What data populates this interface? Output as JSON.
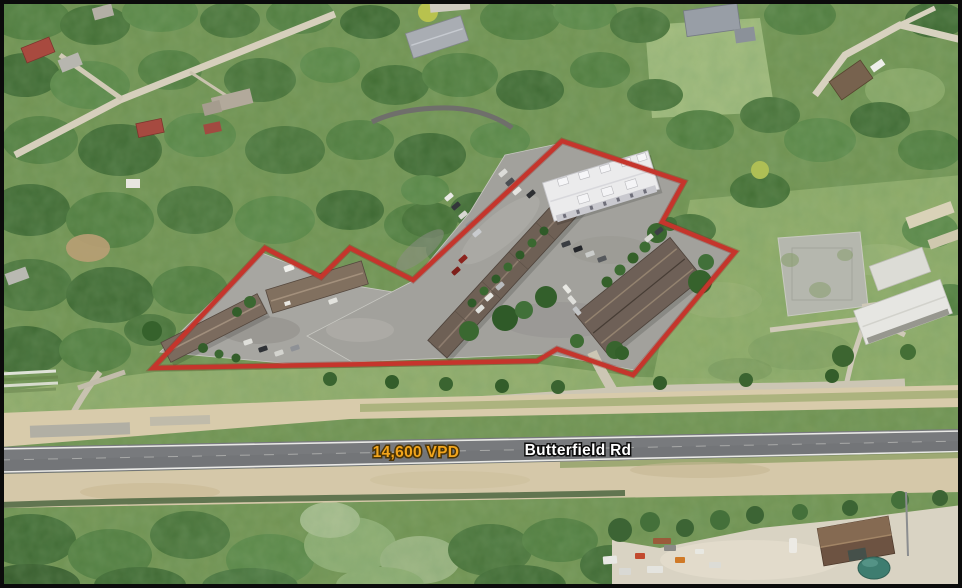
{
  "annotations": {
    "traffic_count": "14,600 VPD",
    "road_name": "Butterfield Rd"
  },
  "colors": {
    "property_outline": "#c5352c",
    "traffic_text": "#f2a51c",
    "traffic_text_outline": "#4a3305",
    "road_text": "#ffffff",
    "road_text_outline": "#0c0c0c",
    "border": "#0b0b0b"
  },
  "property": {
    "outline_points": "562,141 684,182 662,222 735,252 633,375 557,349 537,361 153,368 265,248 321,277 350,248 413,280"
  }
}
